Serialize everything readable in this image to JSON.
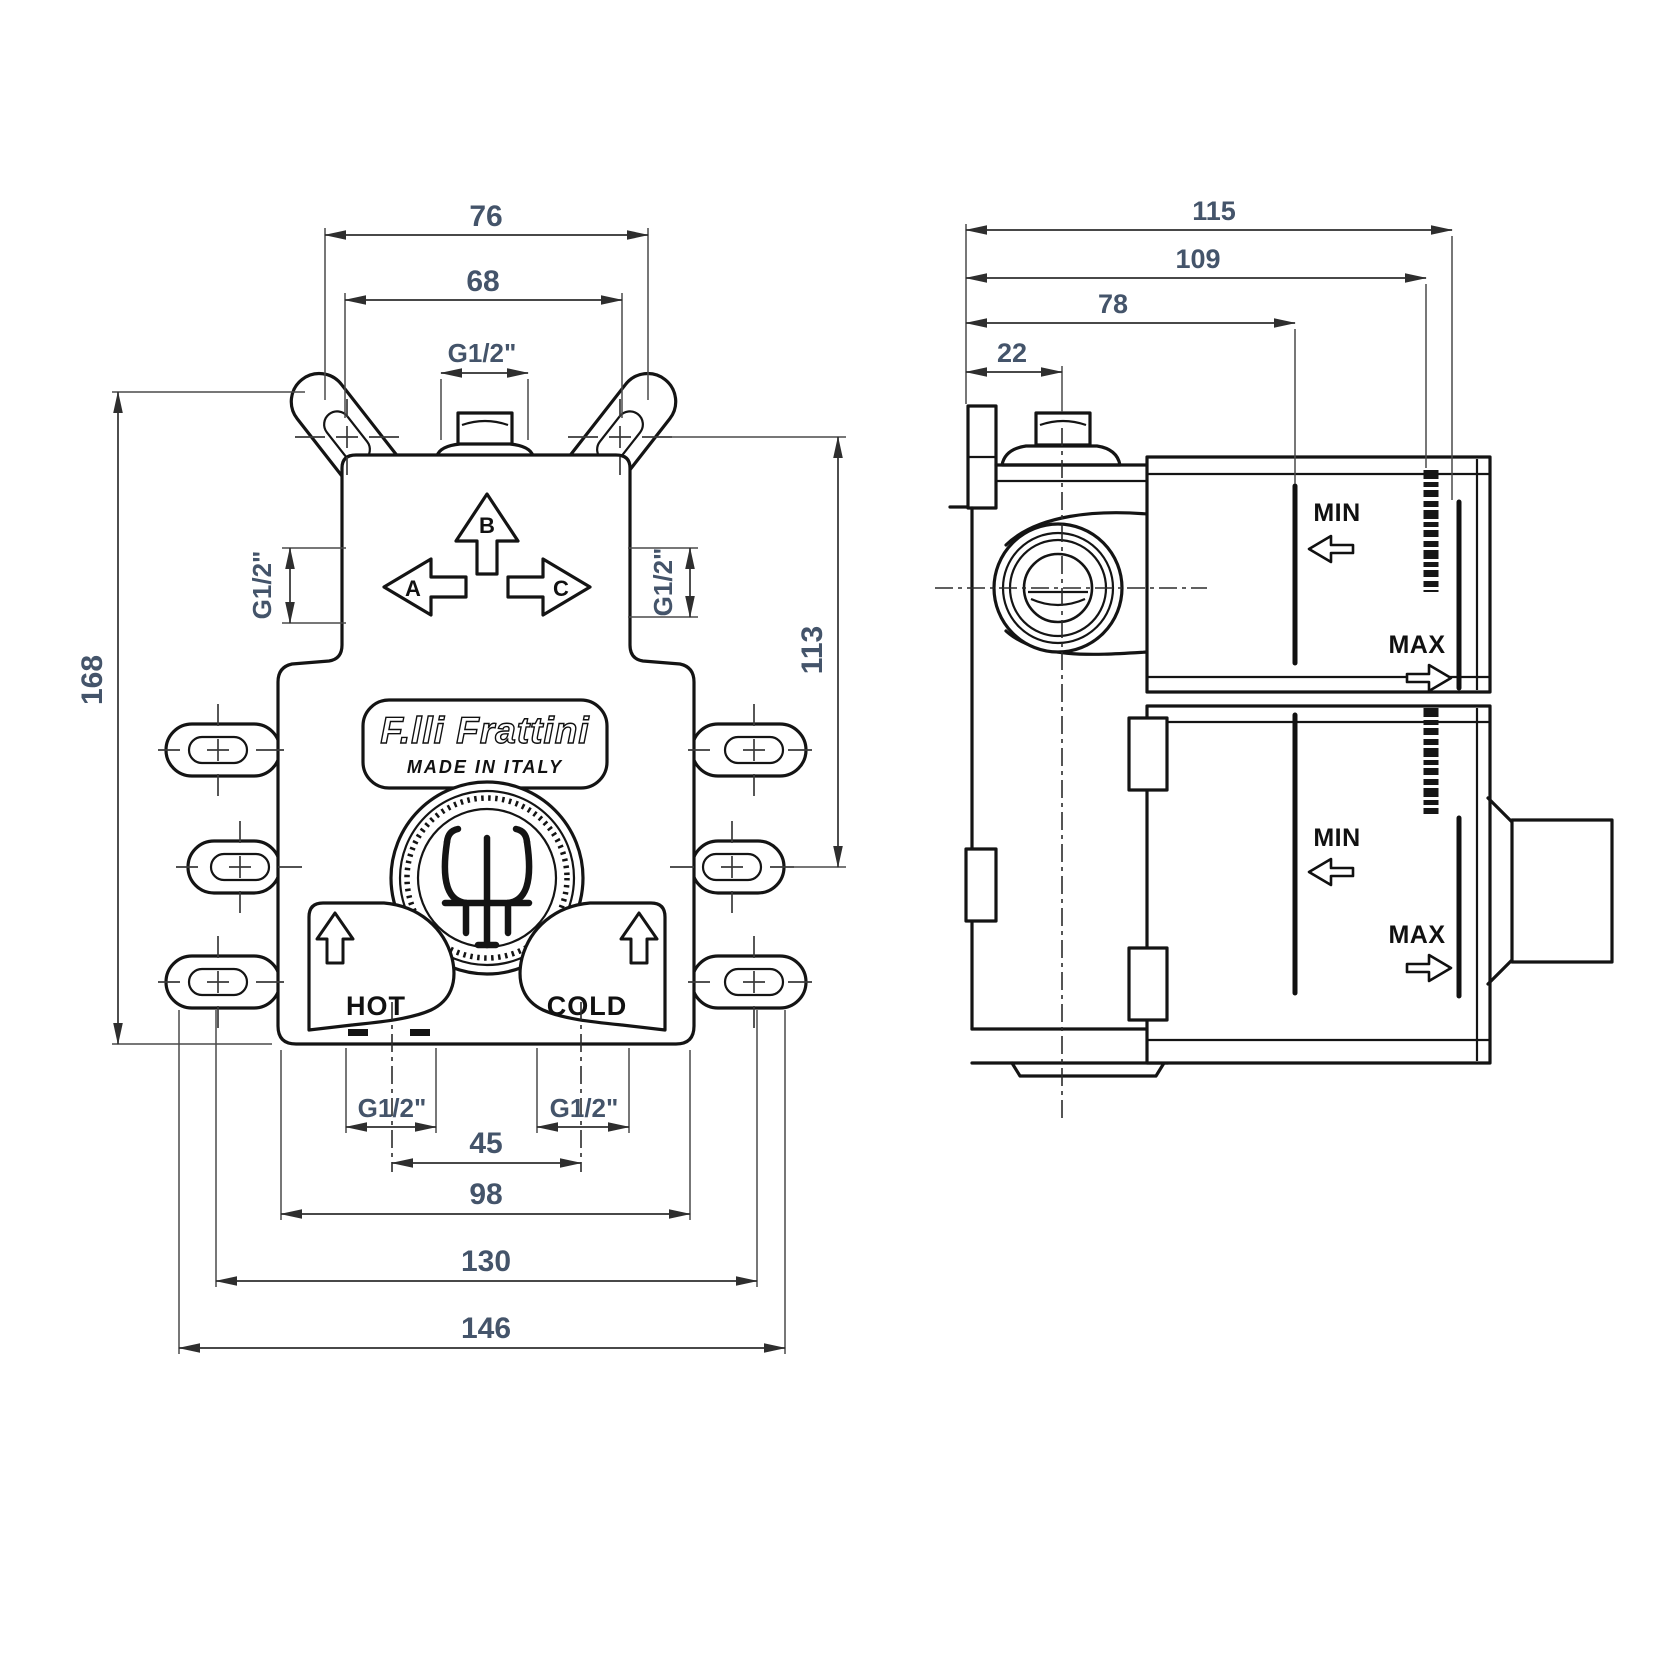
{
  "drawing": {
    "front": {
      "dims": {
        "d76": "76",
        "d68": "68",
        "g_top": "G1/2\"",
        "g_left": "G1/2\"",
        "g_right": "G1/2\"",
        "d168": "168",
        "d113": "113",
        "g_hot": "G1/2\"",
        "g_cold": "G1/2\"",
        "d45": "45",
        "d98": "98",
        "d130": "130",
        "d146": "146"
      },
      "labels": {
        "a": "A",
        "b": "B",
        "c": "C",
        "hot": "HOT",
        "cold": "COLD",
        "brand": "F.lli Frattini",
        "made": "MADE IN ITALY"
      }
    },
    "side": {
      "dims": {
        "d115": "115",
        "d109": "109",
        "d78": "78",
        "d22": "22"
      },
      "labels": {
        "min_top": "MIN",
        "max_top": "MAX",
        "min_bottom": "MIN",
        "max_bottom": "MAX"
      }
    },
    "colors": {
      "line": "#141414",
      "dim_text": "#44546a"
    }
  }
}
